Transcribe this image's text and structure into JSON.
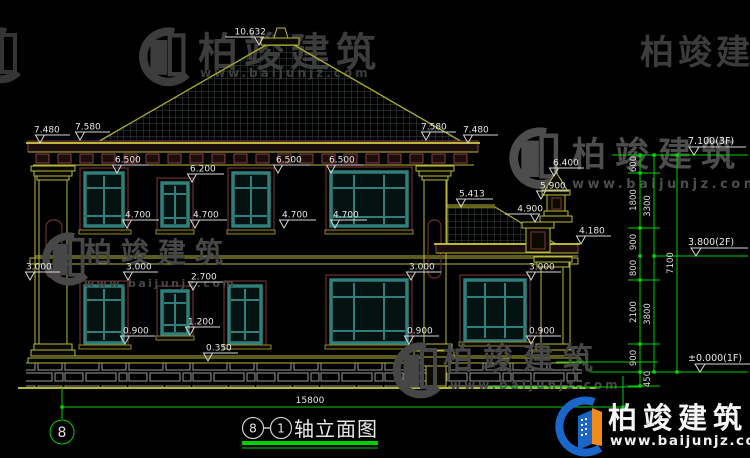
{
  "brand": {
    "name": "柏竣建筑",
    "site": "www.baijunjz.com"
  },
  "title": {
    "axis_left": "8",
    "axis_right": "1",
    "label": "轴立面图"
  },
  "axis_bubble": "8",
  "total_width": "15800",
  "markers": [
    "10.632",
    "7.480",
    "7.580",
    "7.580",
    "7.480",
    "6.500",
    "6.500",
    "6.500",
    "6.200",
    "4.700",
    "4.700",
    "4.700",
    "4.700",
    "5.413",
    "6.400",
    "5.900",
    "4.900",
    "4.180",
    "3.000",
    "3.000",
    "3.000",
    "3.000",
    "2.700",
    "1.200",
    "0.900",
    "0.900",
    "0.900",
    "0.350"
  ],
  "chain": {
    "segments": [
      "600",
      "1800",
      "900",
      "800",
      "2100",
      "900",
      "450"
    ],
    "totals": [
      "3300",
      "3800"
    ],
    "overall": "7100"
  },
  "levels": [
    "7.100(3F)",
    "3.800(2F)",
    "±0.000(1F)"
  ]
}
